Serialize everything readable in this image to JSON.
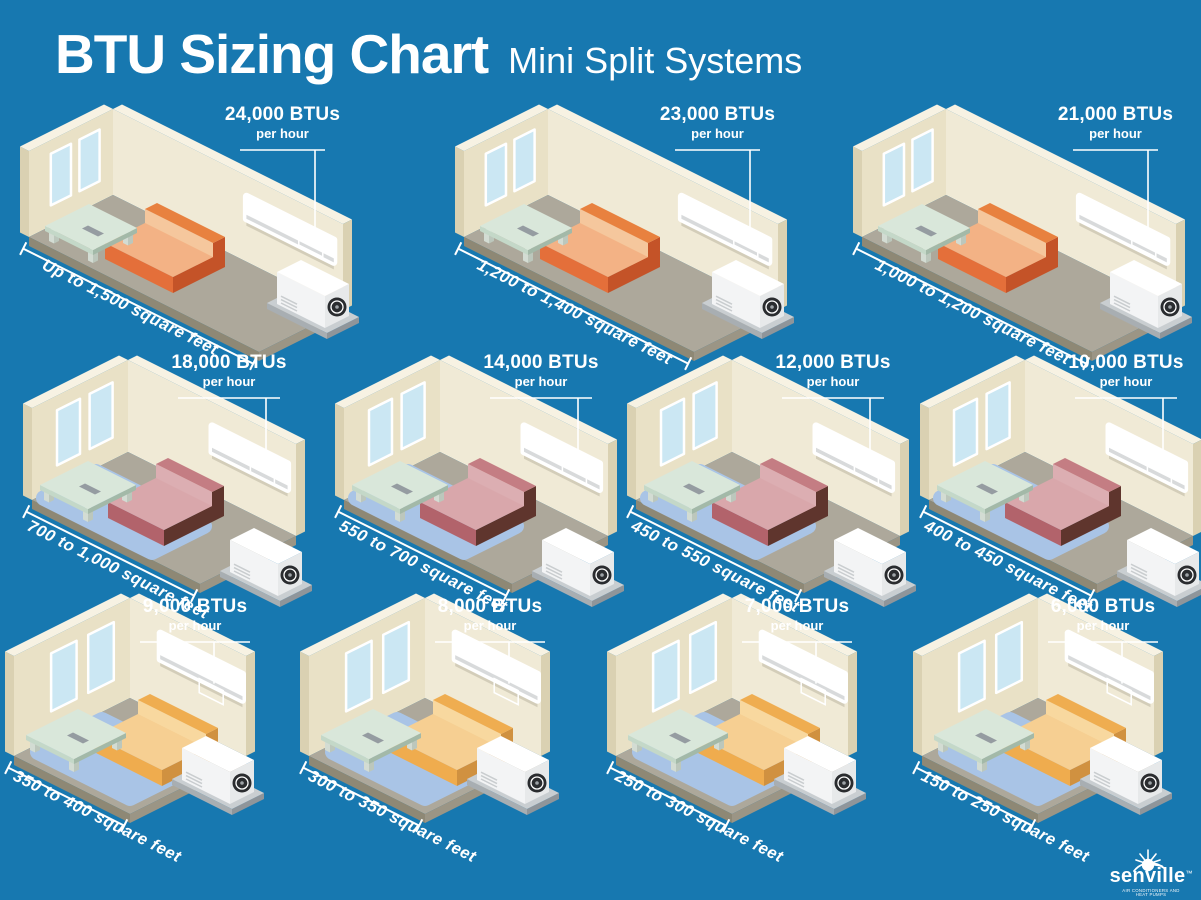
{
  "header": {
    "title": "BTU Sizing Chart",
    "subtitle": "Mini Split Systems"
  },
  "labels": {
    "per_hour": "per hour"
  },
  "colors": {
    "background": "#1778B0",
    "room_wall": "#F0EAD6",
    "room_wall_side": "#E9E1C6",
    "wall_trim": "#DAD1B2",
    "wall_top": "#F7F2E3",
    "floor": "#ADA89B",
    "floor_edge_left": "#8E8875",
    "floor_edge_right": "#9B9585",
    "rug": "#A9C4E6",
    "window": "#CBE7F3",
    "text": "#FFFFFF"
  },
  "rows": [
    {
      "couch": {
        "back_top": "#E8813F",
        "back_inner": "#F5C79D",
        "seat_top": "#F3B285",
        "seat_front": "#E46F3A",
        "side": "#C45328"
      },
      "rooms": [
        {
          "btu": "24,000 BTUs",
          "area": "Up to 1,500 square feet"
        },
        {
          "btu": "23,000 BTUs",
          "area": "1,200 to 1,400 square feet"
        },
        {
          "btu": "21,000 BTUs",
          "area": "1,000 to 1,200 square feet"
        }
      ]
    },
    {
      "couch": {
        "back_top": "#C47D83",
        "back_inner": "#DCAEB2",
        "seat_top": "#D9A7AB",
        "seat_front": "#B2636B",
        "side": "#5F352D"
      },
      "rooms": [
        {
          "btu": "18,000 BTUs",
          "area": "700 to 1,000 square feet"
        },
        {
          "btu": "14,000 BTUs",
          "area": "550 to 700 square feet"
        },
        {
          "btu": "12,000 BTUs",
          "area": "450 to 550 square feet"
        },
        {
          "btu": "10,000 BTUs",
          "area": "400 to 450 square feet"
        }
      ]
    },
    {
      "couch": {
        "back_top": "#EFAD50",
        "back_inner": "#F8D89F",
        "seat_top": "#F6CF92",
        "seat_front": "#EFAC4E",
        "side": "#D09140"
      },
      "rooms": [
        {
          "btu": "9,000 BTUs",
          "area": "350 to 400 square feet"
        },
        {
          "btu": "8,000 BTUs",
          "area": "300 to 350 square feet"
        },
        {
          "btu": "7,000 BTUs",
          "area": "250 to 300 square feet"
        },
        {
          "btu": "6,000 BTUs",
          "area": "150 to 250 square feet"
        }
      ]
    }
  ],
  "logo": {
    "name": "senville",
    "trademark": "™",
    "tagline": "AIR CONDITIONERS AND HEAT PUMPS"
  },
  "chart_data": {
    "type": "table",
    "title": "BTU Sizing Chart — Mini Split Systems",
    "columns": [
      "Cooling capacity (BTUs per hour)",
      "Room size (square feet)"
    ],
    "rows": [
      [
        "24,000",
        "Up to 1,500"
      ],
      [
        "23,000",
        "1,200 to 1,400"
      ],
      [
        "21,000",
        "1,000 to 1,200"
      ],
      [
        "18,000",
        "700 to 1,000"
      ],
      [
        "14,000",
        "550 to 700"
      ],
      [
        "12,000",
        "450 to 550"
      ],
      [
        "10,000",
        "400 to 450"
      ],
      [
        "9,000",
        "350 to 400"
      ],
      [
        "8,000",
        "300 to 350"
      ],
      [
        "7,000",
        "250 to 300"
      ],
      [
        "6,000",
        "150 to 250"
      ]
    ]
  }
}
